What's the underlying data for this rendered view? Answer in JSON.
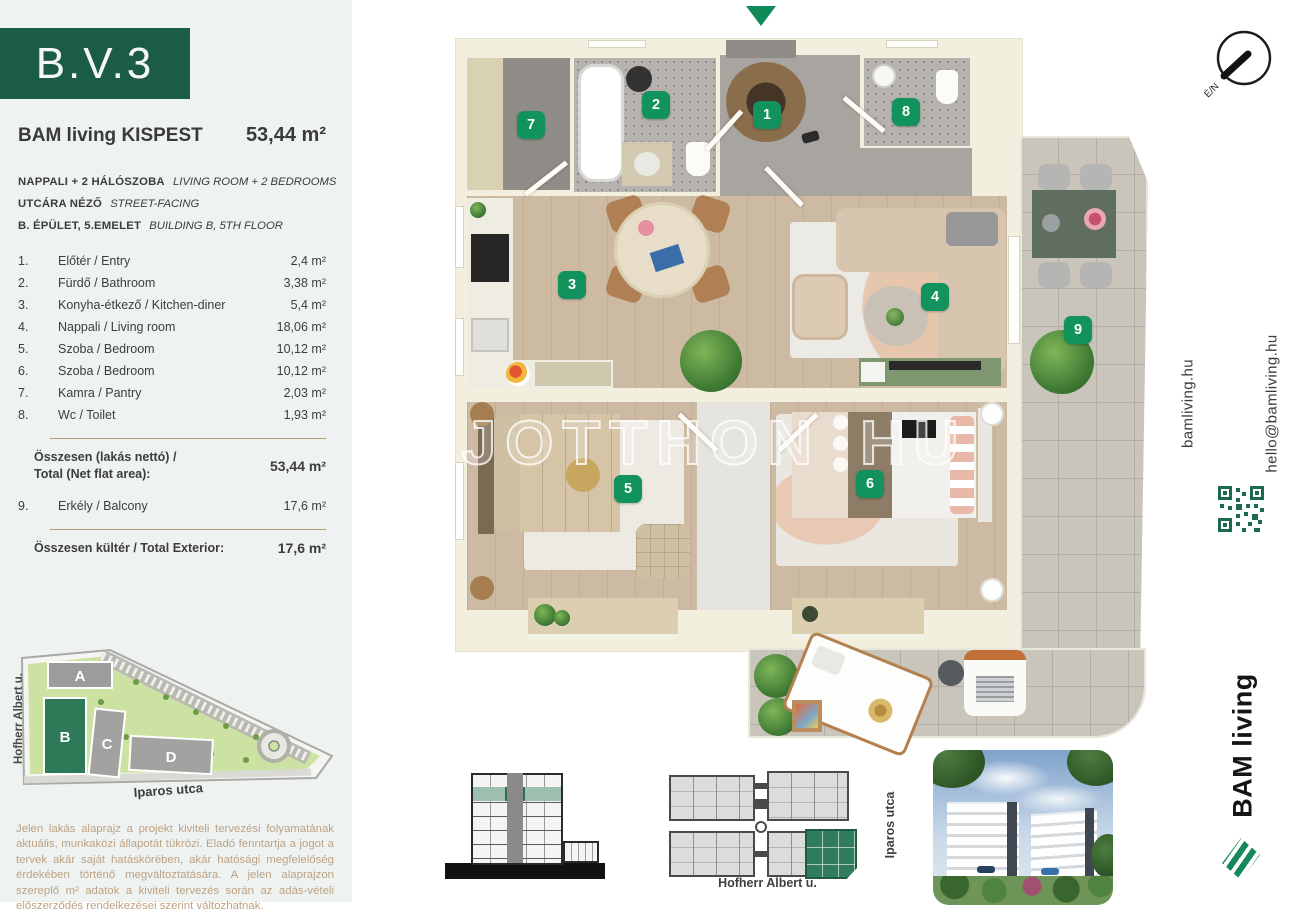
{
  "unit": {
    "code": "B.V.3",
    "project": "BAM living KISPEST",
    "area": "53,44 m²"
  },
  "specs": [
    {
      "hu": "NAPPALI + 2 HÁLÓSZOBA",
      "en": "LIVING ROOM + 2 BEDROOMS"
    },
    {
      "hu": "UTCÁRA NÉZŐ",
      "en": "STREET-FACING"
    },
    {
      "hu": "B. ÉPÜLET, 5.EMELET",
      "en": "BUILDING B, 5TH FLOOR"
    }
  ],
  "rooms": [
    {
      "num": "1",
      "num_label": "1.",
      "name": "Előtér / Entry",
      "area": "2,4 m²"
    },
    {
      "num": "2",
      "num_label": "2.",
      "name": "Fürdő / Bathroom",
      "area": "3,38 m²"
    },
    {
      "num": "3",
      "num_label": "3.",
      "name": "Konyha-étkező / Kitchen-diner",
      "area": "5,4 m²"
    },
    {
      "num": "4",
      "num_label": "4.",
      "name": "Nappali / Living room",
      "area": "18,06 m²"
    },
    {
      "num": "5",
      "num_label": "5.",
      "name": "Szoba / Bedroom",
      "area": "10,12 m²"
    },
    {
      "num": "6",
      "num_label": "6.",
      "name": "Szoba / Bedroom",
      "area": "10,12 m²"
    },
    {
      "num": "7",
      "num_label": "7.",
      "name": "Kamra / Pantry",
      "area": "2,03 m²"
    },
    {
      "num": "8",
      "num_label": "8.",
      "name": "Wc / Toilet",
      "area": "1,93 m²"
    },
    {
      "num": "9",
      "num_label": "9.",
      "name": "Erkély / Balcony",
      "area": "17,6 m²"
    }
  ],
  "totals": {
    "net_label_line1": "Összesen (lakás nettó) /",
    "net_label_line2": "Total (Net flat area):",
    "net_value": "53,44 m²",
    "ext_label": "Összesen kültér / Total Exterior:",
    "ext_value": "17,6 m²"
  },
  "site_map": {
    "buildings": [
      "A",
      "B",
      "C",
      "D"
    ],
    "street_left": "Hofherr Albert u.",
    "street_bottom": "Iparos utca"
  },
  "disclaimer": "Jelen lakás alaprajz a projekt kiviteli tervezési folyamatának aktuális, munkaközi állapotát tükrözi. Eladó fenntartja a jogot a tervek akár saját hatáskörében, akár hatósági megfelelőség érdekében történő megváltoztatására. A jelen alaprajzon szereplő m² adatok a kiviteli tervezés során az adás-vételi előszerződés rendelkezései szerint változhatnak.",
  "watermark": {
    "part1": "UJOTTHON",
    "part2": "HU"
  },
  "compass": {
    "label": "É/N"
  },
  "contact": {
    "website": "bamliving.hu",
    "email": "hello@bamliving.hu"
  },
  "brand": {
    "logo_text": "BAM living"
  },
  "bottom_diagrams": {
    "street_bottom": "Hofherr Albert u.",
    "street_right": "Iparos utca"
  },
  "colors": {
    "brand_green": "#1b5c48",
    "badge_green": "#12935e",
    "tan_text": "#bda283",
    "wall_cream": "#f3efde"
  }
}
